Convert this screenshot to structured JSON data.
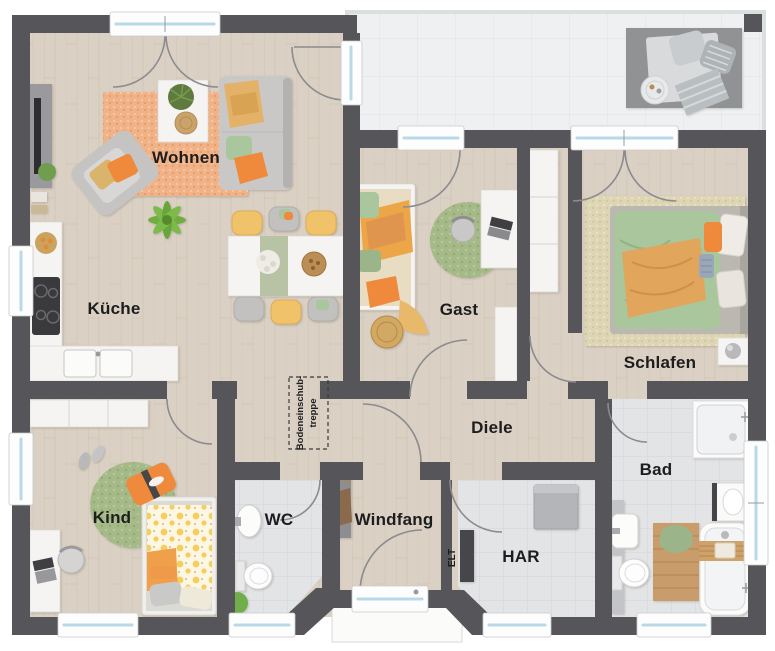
{
  "plan": {
    "title": "floor-plan",
    "rooms": {
      "wohnen": {
        "label": "Wohnen"
      },
      "kueche": {
        "label": "Küche"
      },
      "gast": {
        "label": "Gast"
      },
      "schlafen": {
        "label": "Schlafen"
      },
      "diele": {
        "label": "Diele"
      },
      "kind": {
        "label": "Kind"
      },
      "wc": {
        "label": "WC"
      },
      "windfang": {
        "label": "Windfang"
      },
      "har": {
        "label": "HAR"
      },
      "bad": {
        "label": "Bad"
      }
    },
    "annotations": {
      "elt": "ELT",
      "attic_line1": "Bodeneinschub-",
      "attic_line2": "treppe"
    },
    "colors": {
      "wall": "#56565a",
      "glass": "#b9d9e6",
      "label": "#1d1d1f",
      "wood": "#dad0c3",
      "tilefloor": "#e3e4e6",
      "terrace": "#eef0f1",
      "rug_orange": "#f0b286",
      "rug_green": "#a5ba88",
      "accent_orange": "#ef8a3d",
      "accent_green": "#a9c69c",
      "accent_yellow": "#f0c36a",
      "sofa_gray": "#c9c8c6"
    }
  }
}
